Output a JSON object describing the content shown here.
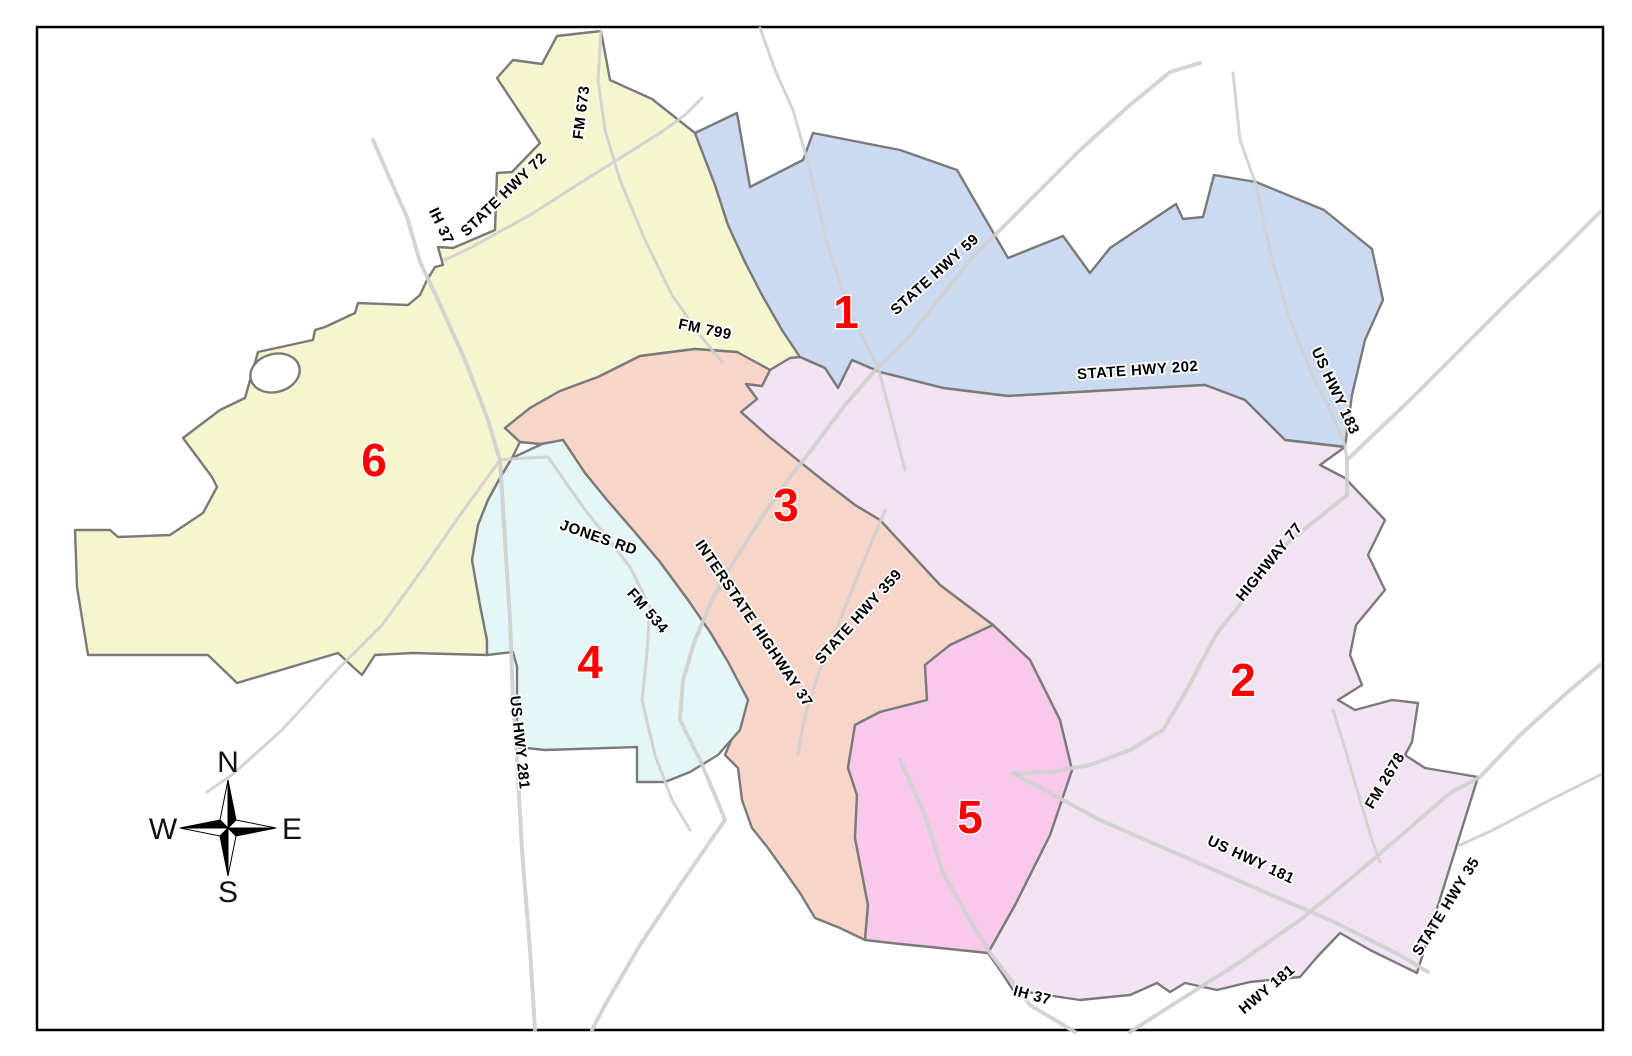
{
  "map": {
    "districts": [
      {
        "id": 1,
        "label": "1",
        "color": "#cbd9f1"
      },
      {
        "id": 2,
        "label": "2",
        "color": "#f1e3f2"
      },
      {
        "id": 3,
        "label": "3",
        "color": "#f8d5c9"
      },
      {
        "id": 4,
        "label": "4",
        "color": "#e4f6f5"
      },
      {
        "id": 5,
        "label": "5",
        "color": "#f8c9eb"
      },
      {
        "id": 6,
        "label": "6",
        "color": "#f5f6cf"
      }
    ],
    "number_color": "#ff0000",
    "road_labels": [
      {
        "id": "ih-37-north",
        "text": "IH 37"
      },
      {
        "id": "state-hwy-72",
        "text": "STATE HWY 72"
      },
      {
        "id": "fm-673",
        "text": "FM 673"
      },
      {
        "id": "fm-799",
        "text": "FM 799"
      },
      {
        "id": "state-hwy-59",
        "text": "STATE HWY 59"
      },
      {
        "id": "state-hwy-202",
        "text": "STATE HWY 202"
      },
      {
        "id": "us-hwy-183",
        "text": "US HWY 183"
      },
      {
        "id": "highway-77",
        "text": "HIGHWAY 77"
      },
      {
        "id": "jones-rd",
        "text": "JONES RD"
      },
      {
        "id": "fm-534",
        "text": "FM 534"
      },
      {
        "id": "interstate-highway-37",
        "text": "INTERSTATE HIGHWAY 37"
      },
      {
        "id": "state-hwy-359",
        "text": "STATE HWY 359"
      },
      {
        "id": "us-hwy-281",
        "text": "US HWY 281"
      },
      {
        "id": "fm-2678",
        "text": "FM 2678"
      },
      {
        "id": "us-hwy-181",
        "text": "US HWY 181"
      },
      {
        "id": "state-hwy-35",
        "text": "STATE HWY 35"
      },
      {
        "id": "ih-37-south",
        "text": "IH 37"
      },
      {
        "id": "hwy-181",
        "text": "HWY 181"
      }
    ],
    "compass": {
      "north": "N",
      "south": "S",
      "east": "E",
      "west": "W"
    }
  }
}
